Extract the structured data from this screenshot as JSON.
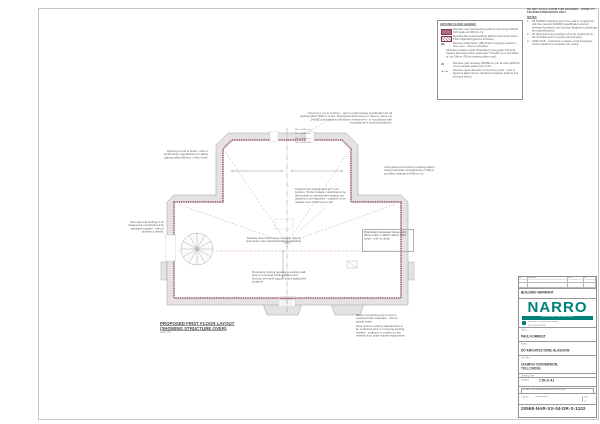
{
  "colors": {
    "teal": "#00807b",
    "wall_lining": "#a8607f",
    "wall_fill": "#e4e3e2",
    "red_line": "#dd9a96",
    "legend_swatch": "#b2688a"
  },
  "notes": {
    "header": "DO NOT SCALE FROM THIS DRAWING - WORK TO FIGURED DIMENSIONS ONLY",
    "title": "NOTES",
    "items": [
      {
        "num": "1.",
        "text": "All NARRO drawings are to be read in conjunction with the relevant NARRO specification and all relevant Architect's and Service Engineer's drawings and specifications."
      },
      {
        "num": "2.",
        "text": "All dimensions and setting out to be confirmed by the Architect prior to works commencing."
      },
      {
        "num": "3.",
        "text": "CDM 2015 - contractor to advise of all temporary works required to complete the works."
      }
    ]
  },
  "legend": {
    "title": "GROUND FLOOR LEGEND:",
    "rows": [
      {
        "key": "",
        "text": "Denotes new load bearing wall formed using 100x44 C24 studs at 400mm crs."
      },
      {
        "key": "",
        "text": "Denotes floor joist boarding laid/formed using 22mm T&G chipboard glued & screwed."
      },
      {
        "key": "SB",
        "text": "Denotes steel beam (SB) lintel to support masonry / floor over - refer to schedule."
      },
      {
        "key": "",
        "text": "All timber (unless noted otherwise) to be grade C24 and treated. Denotes timber joists (per TJI table) to a unit width of min 38mm (35mm bearing either end)."
      },
      {
        "key": "JS",
        "text": "Denotes joist strutting (38x89mm min at max 1350mm crs) to all joist spans over 2.5m."
      },
      {
        "key": "◄—►",
        "text": "Denotes span direction of new floor joists - refer to layout & allow 41mm clearance between joists & any services below."
      }
    ]
  },
  "plan": {
    "title_line1": "PROPOSED FIRST FLOOR LAYOUT",
    "title_line2": "(SHOWING STRUCTURE OVER)",
    "scale_note": "Scale 1:50",
    "leader_labels": [
      "SB1 s over",
      "SB1 s over",
      "SB2 s over",
      "SB2 s over",
      "SB3 s over",
      "SB3 s over",
      "SB4 s over",
      "SB4 s over"
    ],
    "annotations": [
      {
        "text": "Flooring is not to continue - refer to performance specification for all joisting within 300mm of flue. Restricted joists hung on masonry using min 240x62 joist hangers with 68mm embedment - in accordance with manufacturer's recommendations."
      },
      {
        "text": "Opening to roof to lands - refer to performance specification for safety glazing within 800mm of floor level."
      },
      {
        "text": "Joist panels to be fixed to existing rafters using proprietary strengthening of 38mm sq timber dwangs at 600mm crs."
      },
      {
        "text": "Typical truss arrangement at T roof junction. Timber trusses / doublings to be determined on site whether dwangs are required to suit structure - engineer to be notified once confirmed on site."
      },
      {
        "text": "Existing steel frame to be removed; refer to steel beam over schedule before proceeding."
      },
      {
        "text": "Proprietary concealed hanger with 38mm plate to 38x97 rafters (M10 bolts) - refer to detail."
      },
      {
        "text": "Temporary shoring required to existing wall prior to removing existing lathing and forming new steel support beam (padstone) locations."
      },
      {
        "text": "38mm rod reinforcement rows to existing timber wall plate - refer to typical detail."
      },
      {
        "text": "Floor joists to existing wall direction to be confirmed prior to removing existing finishes - engineer to confirm on site whether floor joists require replacement."
      },
      {
        "text": "New stair and landing to be designed & manufactured by specialist supplier - refer to architect's details."
      }
    ]
  },
  "title_block": {
    "rev_headers": [
      "Rev",
      "Description",
      "Date",
      "Drn"
    ],
    "stage": "BUILDING WARRANT",
    "logo": "NARRO",
    "offices": "Edinburgh   Glasgow   Stirling   Dundee   Inverness",
    "address_line1": "Narro House, 3 Woodside Place, Glasgow",
    "address_line2": "G3 7QF  |  0141 332 1622",
    "website": "www.narroassociates.com",
    "client_label": "Client",
    "client": "PAUL FORREST",
    "agent_label": "Agent",
    "agent": "DO ARCHITECTURE GLASGOW",
    "job_label": "Job Title",
    "job_line1": "CHURCH CONVERSION,",
    "job_line2": "TOLLCROSS",
    "drawing_label": "Drawing Title",
    "drawing": "PROPOSED FIRST FLOOR LAYOUT",
    "scale_label": "Scale(s)",
    "scale": "1:50 @ A1",
    "caution": "If in doubt - ask. Confirm all dimensions prior to construction.",
    "cad_label": "Cad ref",
    "cad_ref": "20568-NAR-XX-04",
    "rev_label": "Rev",
    "revision": "P1",
    "drawing_number": "20568-NAR-XX-04-DR-S-1102"
  }
}
